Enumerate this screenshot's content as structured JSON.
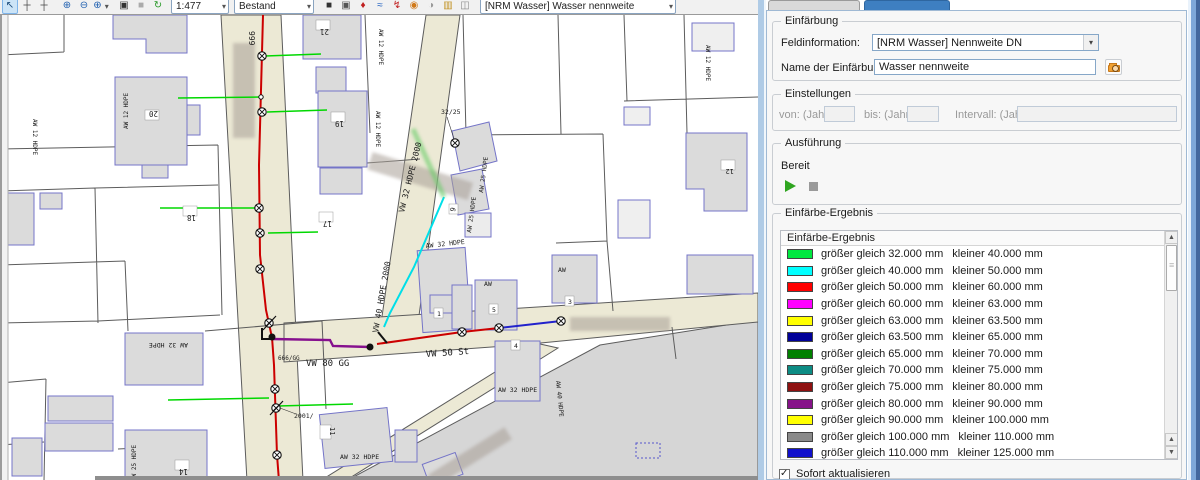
{
  "toolbar": {
    "left": [
      {
        "name": "select",
        "glyph": "↖",
        "color": "#1A4A7A"
      },
      {
        "name": "pan",
        "glyph": "┼",
        "color": "#444444"
      },
      {
        "name": "crosshair",
        "glyph": "┼",
        "color": "#444444"
      },
      {
        "name": "zoom-in",
        "glyph": "⊕",
        "color": "#2060B0"
      },
      {
        "name": "zoom-out",
        "glyph": "⊖",
        "color": "#2060B0"
      },
      {
        "name": "zoom-menu",
        "glyph": "⊕",
        "color": "#2060B0"
      },
      {
        "name": "info",
        "glyph": "▣",
        "color": "#333333"
      },
      {
        "name": "stop",
        "glyph": "■",
        "color": "#ABABAB"
      },
      {
        "name": "refresh",
        "glyph": "↻",
        "color": "#2A9A2A"
      }
    ],
    "scale_value": "1:477",
    "mode_value": "Bestand",
    "mid": [
      {
        "name": "snapshot",
        "glyph": "■",
        "color": "#333333"
      },
      {
        "name": "camera",
        "glyph": "▣",
        "color": "#555555"
      },
      {
        "name": "temperature",
        "glyph": "♦",
        "color": "#C02020"
      },
      {
        "name": "waves",
        "glyph": "≈",
        "color": "#2060C0"
      },
      {
        "name": "flash",
        "glyph": "↯",
        "color": "#C02020"
      },
      {
        "name": "globe",
        "glyph": "◉",
        "color": "#D07818"
      },
      {
        "name": "palette",
        "glyph": "◑",
        "color": "#999999"
      },
      {
        "name": "columns",
        "glyph": "▥",
        "color": "#C09020"
      },
      {
        "name": "users",
        "glyph": "◫",
        "color": "#888888"
      }
    ],
    "layer_value": "[NRM Wasser] Wasser nennweite"
  },
  "map": {
    "labels": [
      {
        "text": "999"
      },
      {
        "text": "21"
      },
      {
        "text": "AW 12 HDPE"
      },
      {
        "text": "AW 12 HDPE"
      },
      {
        "text": "20"
      },
      {
        "text": "19"
      },
      {
        "text": "AW 12 HDPE"
      },
      {
        "text": "18"
      },
      {
        "text": "17"
      },
      {
        "text": "AW 12 HDPE"
      },
      {
        "text": "32/25"
      },
      {
        "text": "VW 32 HDPE 2000"
      },
      {
        "text": "VW 40 HDPE 2000"
      },
      {
        "text": "AW 25 HDPE"
      },
      {
        "text": "AW 25 HDPE"
      },
      {
        "text": "9"
      },
      {
        "text": "AW 32 HDPE"
      },
      {
        "text": "AW"
      },
      {
        "text": "AW"
      },
      {
        "text": "1"
      },
      {
        "text": "5"
      },
      {
        "text": "3"
      },
      {
        "text": "4"
      },
      {
        "text": "666/GG"
      },
      {
        "text": "VW 80 GG"
      },
      {
        "text": "VW 50 St"
      },
      {
        "text": "2001/"
      },
      {
        "text": "11"
      },
      {
        "text": "AW 32 HDPE"
      },
      {
        "text": "AW 32 HDPE"
      },
      {
        "text": "AW 40 HDPE"
      },
      {
        "text": "14"
      },
      {
        "text": "AW 25 HDPE"
      },
      {
        "text": "AW 32 HDPE"
      },
      {
        "text": "12"
      },
      {
        "text": "AW 12 HDPE"
      }
    ],
    "colors": {
      "road": "#ECE9D5",
      "building": "#DBDBDB",
      "building_outline": "#7474C8",
      "parcel_line": "#5C5C5C",
      "main_red": "#CC0000",
      "main_cyan": "#00DFE8",
      "main_purple": "#86108E",
      "main_blue": "#2222CC",
      "service_green": "#00D800",
      "outside_area": "#D6D6D6"
    }
  },
  "panel": {
    "einfaerbung": {
      "title": "Einfärbung",
      "feld_label": "Feldinformation:",
      "feld_value": "[NRM Wasser] Nennweite DN",
      "name_label": "Name der Einfärbung:",
      "name_value": "Wasser nennweite"
    },
    "einstellungen": {
      "title": "Einstellungen",
      "von_label": "von: (Jahr)",
      "von_value": "",
      "bis_label": "bis: (Jahr)",
      "bis_value": "",
      "intervall_label": "Intervall: (Jahre)",
      "intervall_value": ""
    },
    "ausfuehrung": {
      "title": "Ausführung",
      "status": "Bereit"
    },
    "ergebnis": {
      "title": "Einfärbe-Ergebnis",
      "list_header": "Einfärbe-Ergebnis",
      "rows": [
        {
          "color": "#00E840",
          "gte": "größer gleich 32.000 mm",
          "lt": "kleiner 40.000 mm"
        },
        {
          "color": "#00FFFF",
          "gte": "größer gleich 40.000 mm",
          "lt": "kleiner 50.000 mm"
        },
        {
          "color": "#FF0000",
          "gte": "größer gleich 50.000 mm",
          "lt": "kleiner 60.000 mm"
        },
        {
          "color": "#FF00FF",
          "gte": "größer gleich 60.000 mm",
          "lt": "kleiner 63.000 mm"
        },
        {
          "color": "#FFFF00",
          "gte": "größer gleich 63.000 mm",
          "lt": "kleiner 63.500 mm"
        },
        {
          "color": "#000099",
          "gte": "größer gleich 63.500 mm",
          "lt": "kleiner 65.000 mm"
        },
        {
          "color": "#008000",
          "gte": "größer gleich 65.000 mm",
          "lt": "kleiner 70.000 mm"
        },
        {
          "color": "#0D8C84",
          "gte": "größer gleich 70.000 mm",
          "lt": "kleiner 75.000 mm"
        },
        {
          "color": "#8E1111",
          "gte": "größer gleich 75.000 mm",
          "lt": "kleiner 80.000 mm"
        },
        {
          "color": "#861289",
          "gte": "größer gleich 80.000 mm",
          "lt": "kleiner 90.000 mm"
        },
        {
          "color": "#FFFF00",
          "gte": "größer gleich 90.000 mm",
          "lt": "kleiner 100.000 mm"
        },
        {
          "color": "#8A8A8A",
          "gte": "größer gleich 100.000 mm",
          "lt": "kleiner 110.000 mm"
        },
        {
          "color": "#1111CC",
          "gte": "größer gleich 110.000 mm",
          "lt": "kleiner 125.000 mm"
        }
      ]
    },
    "sofort_label": "Sofort aktualisieren",
    "sofort_checked": true
  }
}
